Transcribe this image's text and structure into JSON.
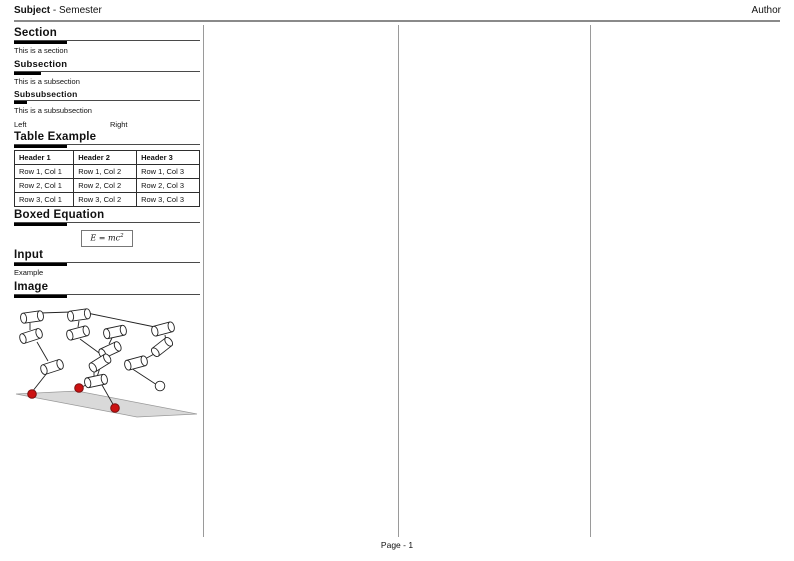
{
  "header": {
    "subject": "Subject",
    "separator": " - ",
    "semester": "Semester",
    "author": "Author"
  },
  "footer": {
    "page_label": "Page - 1"
  },
  "sections": {
    "section": {
      "title": "Section",
      "body": "This is a section"
    },
    "subsection": {
      "title": "Subsection",
      "body": "This is a subsection"
    },
    "subsubsection": {
      "title": "Subsubsection",
      "body": "This is a subsubsection"
    },
    "two_columns": {
      "left": "Left",
      "right": "Right"
    },
    "table_example": {
      "title": "Table Example",
      "headers": [
        "Header 1",
        "Header 2",
        "Header 3"
      ],
      "rows": [
        [
          "Row 1, Col 1",
          "Row 1, Col 2",
          "Row 1, Col 3"
        ],
        [
          "Row 2, Col 1",
          "Row 2, Col 2",
          "Row 2, Col 3"
        ],
        [
          "Row 3, Col 1",
          "Row 3, Col 2",
          "Row 3, Col 3"
        ]
      ]
    },
    "boxed_equation": {
      "title": "Boxed Equation",
      "lhs": "E = mc",
      "exponent": "2"
    },
    "input": {
      "title": "Input",
      "body": "Example"
    },
    "image": {
      "title": "Image"
    }
  },
  "figure": {
    "name": "robot-linkage-diagram",
    "ground_fill": "#d9d9d9",
    "contact_color": "#cc1111",
    "contact_stroke": "#7a1010"
  }
}
